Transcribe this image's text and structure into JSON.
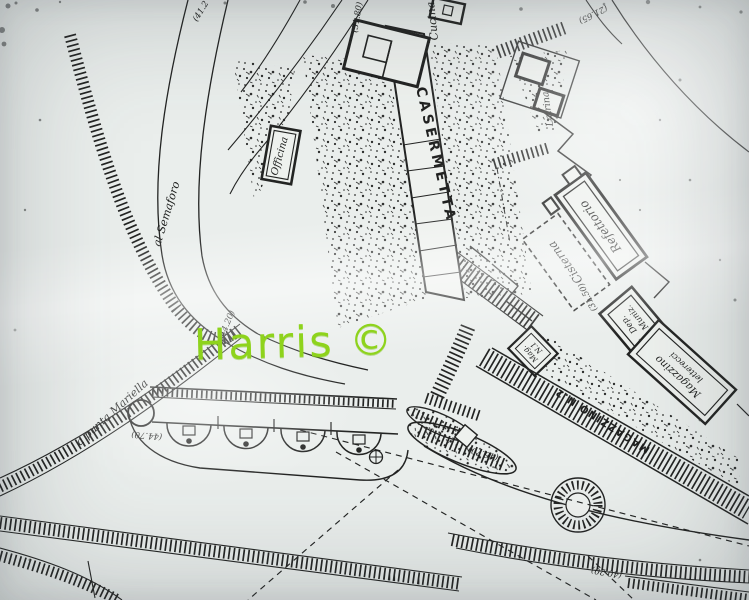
{
  "watermark": {
    "text": "Harris ©",
    "color": "#8ed31c"
  },
  "plan": {
    "buildings": {
      "casermetta": "CASERMETTA",
      "cucina": "Cucina",
      "latrina": "Latrina",
      "officina": "Officina",
      "refettorio": "Refettorio",
      "cisterna": "Cisterna",
      "dep_muniz": {
        "line1": "Dep.",
        "line2": "Muniz."
      },
      "magazzino_letterecci": {
        "line1": "Magazzino",
        "line2": "letterecci"
      },
      "mag_n1": {
        "line1": "Mag.",
        "line2": "N.1"
      },
      "magazzino_n2": "MAGAZZINO N.2"
    },
    "roads": {
      "semaforo": "al Semaforo",
      "mariella": "a punta Mariella"
    },
    "elevations": {
      "nw": "(41.2",
      "north": "(31.80)",
      "ne": "(21.65)",
      "cisterna_area": "(31.50)",
      "junction": "(44.20)",
      "battery_left": "(44.70)",
      "center": "(46.70)",
      "south": "(40.20)"
    },
    "colors": {
      "ink": "#232423",
      "paper": "#eef1ee",
      "watermark_green": "#8ed31c"
    }
  }
}
